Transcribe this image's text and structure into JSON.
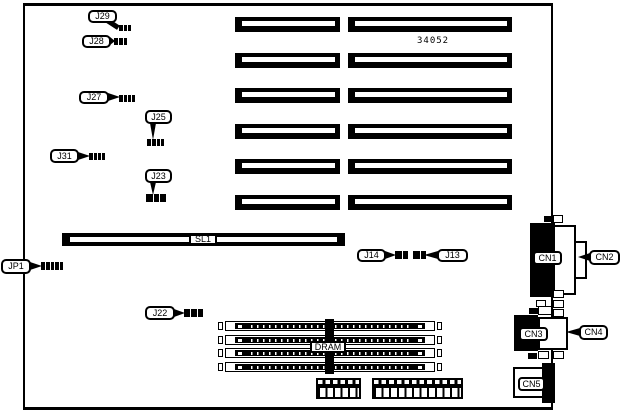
{
  "colors": {
    "ink": "#000000",
    "paper": "#ffffff"
  },
  "part_number": {
    "text": "34052",
    "x": 417,
    "y": 36,
    "w": 40,
    "h": 10
  },
  "board": {
    "x": 23,
    "y": 3,
    "w": 530,
    "h": 407,
    "border_top": 3,
    "border_side": 2,
    "border_bottom": 3
  },
  "slots": {
    "ys": [
      17,
      53,
      88,
      124,
      159,
      195
    ],
    "h": 15,
    "cols": [
      {
        "x": 235,
        "w": 105
      },
      {
        "x": 348,
        "w": 164
      }
    ],
    "stripe": {
      "left": 7,
      "right": 5,
      "top": 4,
      "h": 5
    }
  },
  "sl1_bar": {
    "x": 62,
    "y": 233,
    "w": 283,
    "h": 13,
    "stripe": {
      "left": 8,
      "right": 8,
      "top": 4,
      "h": 5
    }
  },
  "simms": {
    "x": 218,
    "w": 224,
    "h": 10,
    "ys": [
      321,
      334.5,
      348,
      361.5
    ]
  },
  "headers": [
    {
      "x": 316,
      "y": 378,
      "w": 45,
      "h": 21,
      "pitch": 7.5
    },
    {
      "x": 372,
      "y": 378,
      "w": 91,
      "h": 21,
      "pitch": 7.6
    }
  ],
  "connectors": [
    {
      "name": "cn1-body",
      "x": 530,
      "y": 223,
      "w": 25,
      "h": 74,
      "fill": "black"
    },
    {
      "name": "cn2-body",
      "x": 553,
      "y": 225,
      "w": 23,
      "h": 70,
      "fill": "white",
      "border": 2
    },
    {
      "name": "cn2-nose",
      "x": 574,
      "y": 241,
      "w": 13,
      "h": 38,
      "fill": "white",
      "border": 2
    },
    {
      "name": "cn3-body",
      "x": 514,
      "y": 315,
      "w": 24,
      "h": 36,
      "fill": "black"
    },
    {
      "name": "cn3-dsub",
      "x": 538,
      "y": 317,
      "w": 30,
      "h": 33,
      "fill": "white",
      "border": 2
    },
    {
      "name": "cn5-body",
      "x": 513,
      "y": 367,
      "w": 31,
      "h": 31,
      "fill": "white",
      "border": 2
    },
    {
      "name": "cn5-black",
      "x": 542,
      "y": 363,
      "w": 13,
      "h": 40,
      "fill": "black"
    }
  ],
  "decor": [
    {
      "name": "tab",
      "x": 553,
      "y": 215,
      "w": 10,
      "h": 8,
      "fill": "white",
      "border": 1
    },
    {
      "name": "tab",
      "x": 544,
      "y": 216,
      "w": 8,
      "h": 6,
      "fill": "black"
    },
    {
      "name": "tab",
      "x": 553,
      "y": 290,
      "w": 11,
      "h": 8,
      "fill": "white",
      "border": 1
    },
    {
      "name": "tab",
      "x": 553,
      "y": 300,
      "w": 11,
      "h": 8,
      "fill": "white",
      "border": 1
    },
    {
      "name": "tab",
      "x": 536,
      "y": 300,
      "w": 10,
      "h": 7,
      "fill": "white",
      "border": 1
    },
    {
      "name": "tab",
      "x": 538,
      "y": 306,
      "w": 14,
      "h": 9,
      "fill": "white",
      "border": 1
    },
    {
      "name": "tab",
      "x": 529,
      "y": 308,
      "w": 9,
      "h": 6,
      "fill": "black"
    },
    {
      "name": "tab",
      "x": 553,
      "y": 309,
      "w": 11,
      "h": 8,
      "fill": "white",
      "border": 1
    },
    {
      "name": "tab",
      "x": 528,
      "y": 353,
      "w": 9,
      "h": 6,
      "fill": "black"
    },
    {
      "name": "tab",
      "x": 538,
      "y": 351,
      "w": 11,
      "h": 8,
      "fill": "white",
      "border": 1
    },
    {
      "name": "tab",
      "x": 553,
      "y": 351,
      "w": 11,
      "h": 8,
      "fill": "white",
      "border": 1
    }
  ],
  "plain_labels": [
    {
      "id": "SL1",
      "text": "SL1",
      "x": 189,
      "y": 234,
      "w": 28,
      "h": 11,
      "radius": 2
    },
    {
      "id": "DRAM",
      "text": "DRAM",
      "x": 310,
      "y": 341,
      "w": 36,
      "h": 12,
      "radius": 2
    },
    {
      "id": "CN1",
      "text": "CN1",
      "x": 533,
      "y": 251,
      "w": 29,
      "h": 14,
      "radius": 4
    },
    {
      "id": "CN3",
      "text": "CN3",
      "x": 519,
      "y": 327,
      "w": 29,
      "h": 14,
      "radius": 4
    },
    {
      "id": "CN5",
      "text": "CN5",
      "x": 518,
      "y": 377,
      "w": 27,
      "h": 14,
      "radius": 4
    }
  ],
  "callouts": [
    {
      "id": "J29",
      "label": "J29",
      "box": [
        88,
        10,
        29,
        13
      ],
      "pointer": "diag",
      "jumper": [
        119,
        25,
        12,
        6
      ],
      "pins": 3
    },
    {
      "id": "J28",
      "label": "J28",
      "box": [
        82,
        35,
        29,
        13
      ],
      "pointer": "right",
      "jumper": [
        114,
        38,
        13,
        7
      ],
      "pins": 3
    },
    {
      "id": "J27",
      "label": "J27",
      "box": [
        79,
        91,
        30,
        13
      ],
      "pointer": "right",
      "jumper": [
        119,
        95,
        16,
        7
      ],
      "pins": 4
    },
    {
      "id": "J25",
      "label": "J25",
      "box": [
        145,
        110,
        27,
        14
      ],
      "pointer": "down",
      "jumper": [
        147,
        139,
        17,
        7
      ],
      "pins": 4
    },
    {
      "id": "J31",
      "label": "J31",
      "box": [
        50,
        149,
        29,
        14
      ],
      "pointer": "right",
      "jumper": [
        89,
        153,
        16,
        7
      ],
      "pins": 4
    },
    {
      "id": "J23",
      "label": "J23",
      "box": [
        145,
        169,
        27,
        14
      ],
      "pointer": "down",
      "jumper": [
        146,
        194,
        20,
        8
      ],
      "pins": 3
    },
    {
      "id": "JP1",
      "label": "JP1",
      "box": [
        1,
        259,
        30,
        15
      ],
      "pointer": "right",
      "jumper": [
        41,
        262,
        22,
        8
      ],
      "pins": 5
    },
    {
      "id": "J22",
      "label": "J22",
      "box": [
        145,
        306,
        30,
        14
      ],
      "pointer": "right",
      "jumper": [
        184,
        309,
        19,
        8
      ],
      "pins": 3
    },
    {
      "id": "J14",
      "label": "J14",
      "box": [
        357,
        249,
        29,
        13
      ],
      "pointer": "right",
      "jumper": [
        395,
        251,
        13,
        8
      ],
      "pins": 2
    },
    {
      "id": "J13",
      "label": "J13",
      "box": [
        437,
        249,
        31,
        13
      ],
      "pointer": "left",
      "jumper": [
        413,
        251,
        13,
        8
      ],
      "pins": 2
    },
    {
      "id": "CN2",
      "label": "CN2",
      "box": [
        589,
        250,
        31,
        15
      ],
      "pointer": "left",
      "target_x": 578
    },
    {
      "id": "CN4",
      "label": "CN4",
      "box": [
        579,
        325,
        29,
        15
      ],
      "pointer": "left",
      "target_x": 566
    }
  ]
}
